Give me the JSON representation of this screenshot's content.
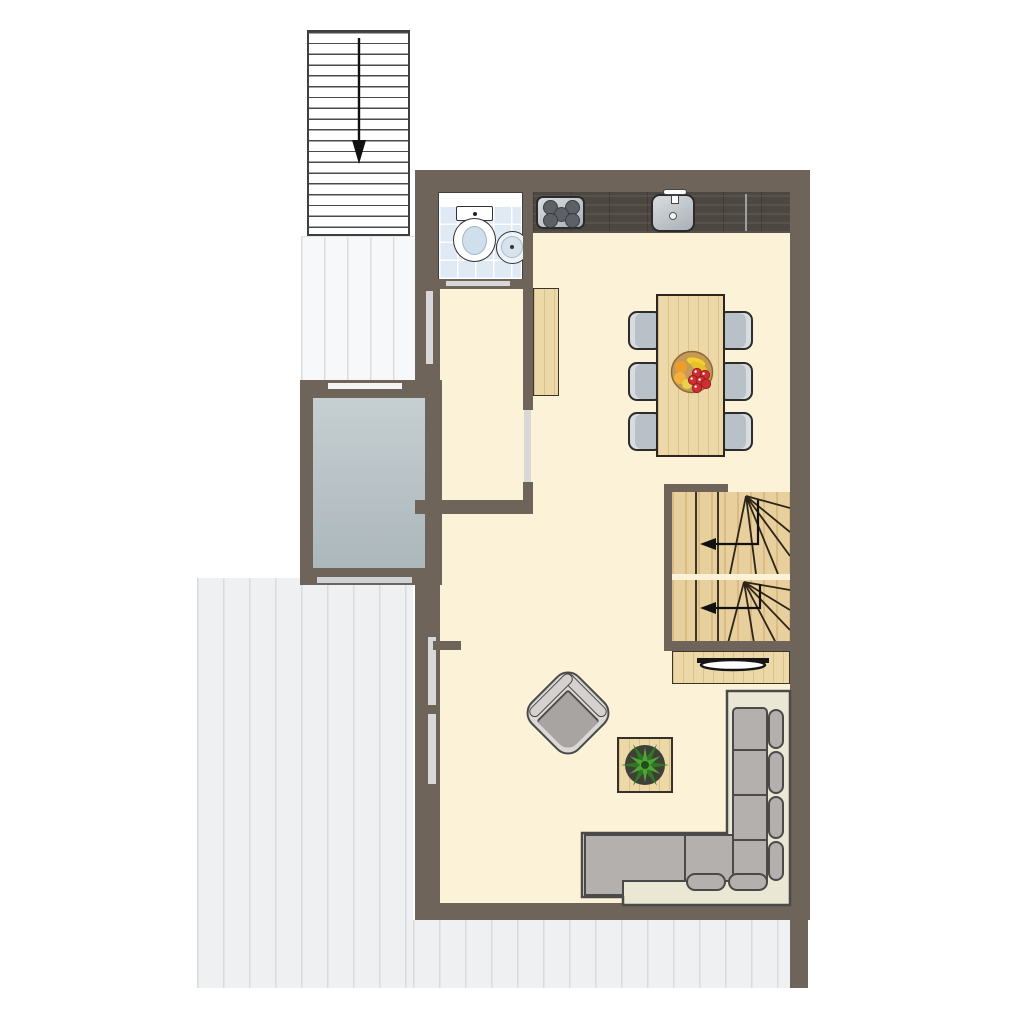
{
  "plan_type": "apartment floor plan (no text labels in drawing)",
  "colors": {
    "wall": "#6e6459",
    "floor": "#fcf2d7",
    "deck": "#eef0f2",
    "deck-line": "#d8dcdf",
    "void-a": "#c6cfd2",
    "void-b": "#acb7bb",
    "tile": "#dfeaf4",
    "counter": "#4d4742",
    "steel-a": "#d9dde0",
    "steel-b": "#a9b0b5",
    "burner": "#5d6165",
    "wood": "#ecd9a7",
    "stair-wood": "#e7cf9e",
    "stair-line": "#2e2417",
    "chair": "#b9c1c8",
    "chair-edge": "#d9dcdf",
    "sofa-base": "#ebe7d5",
    "sofa-cushion": "#b3b0ad",
    "sofa-line": "#4a4a4a",
    "armchair-light": "#dbd8d5",
    "armchair-seat": "#a7a4a1",
    "pot": "#3e3f37",
    "leaf-a": "#2e7a24",
    "leaf-b": "#52a336",
    "bowl": "#c49a5c",
    "banana": "#f2cf3a",
    "orange": "#ef9d2a",
    "grape": "#cf2f33",
    "tv": "#161616",
    "arrow": "#111111",
    "panel": "#d6d6d6"
  },
  "arrows": {
    "exterior_staircase": "down",
    "stair_upper_flight": "left",
    "stair_lower_flight": "left"
  },
  "furniture": {
    "exterior_staircase": "exterior staircase going down",
    "terrace_deck": "plank terrace deck",
    "landing_deck": "entrance landing deck",
    "planter": "planter / void opening",
    "bathroom": "bathroom",
    "toilet": "toilet",
    "washbasin": "washbasin",
    "hall_cabinet": "hall cabinet",
    "worktop": "kitchen worktop",
    "hob": "5-burner hob",
    "kitchen_sink": "kitchen sink with tap",
    "dining_table": "dining table",
    "dining_chair": "dining chair",
    "fruit_bowl": "fruit bowl",
    "stairs_upper": "winder stair upper flight",
    "stairs_lower": "winder stair lower flight",
    "tv_sideboard": "TV sideboard",
    "tv": "television",
    "corner_sofa": "corner sofa",
    "armchair": "armchair",
    "coffee_table": "coffee table",
    "plant": "potted plant",
    "sliding_door": "glazed door panel"
  }
}
